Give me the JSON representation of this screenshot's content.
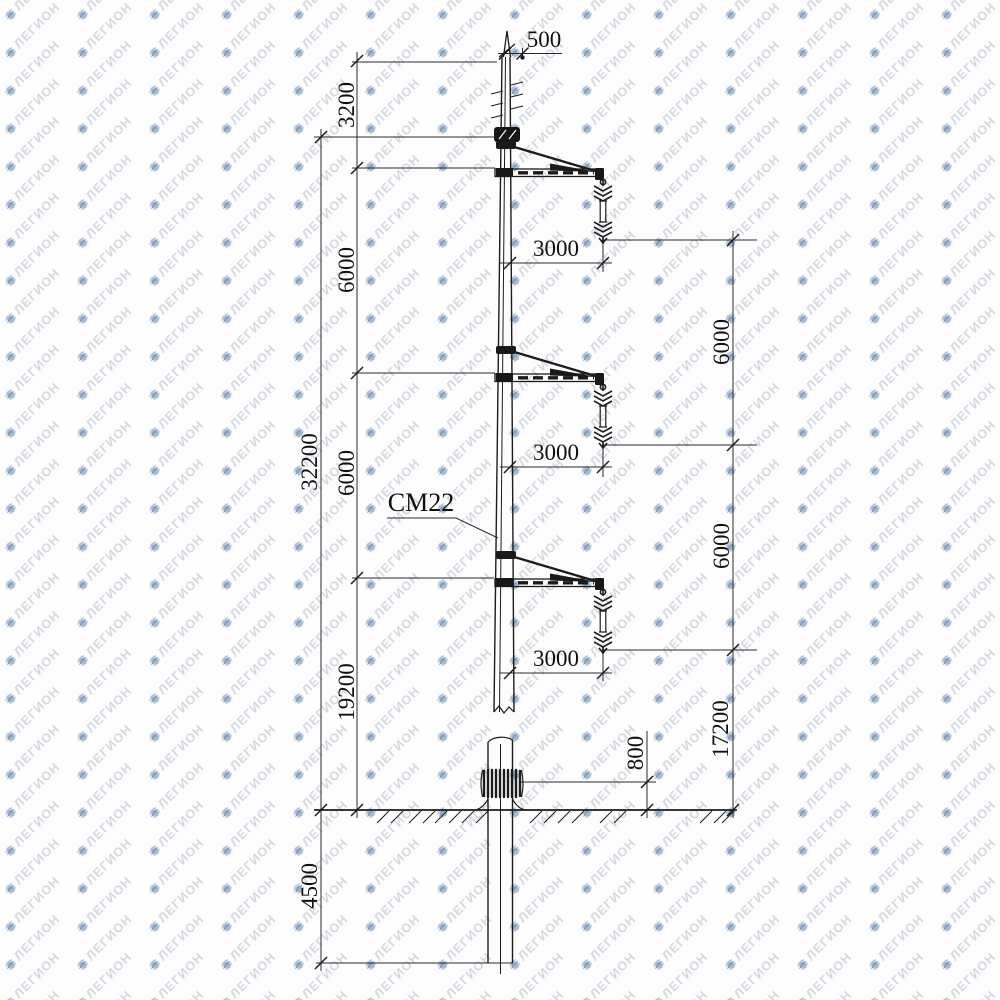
{
  "watermark": {
    "text": "ЛЕГИОН",
    "text_color": "#c9ceda",
    "icon": "legion-stack-logo",
    "icon_color": "#86a3c5"
  },
  "drawing": {
    "pole_model_label": "СМ22",
    "dims": {
      "top_offset": "500",
      "left": [
        "3200",
        "6000",
        "6000",
        "19200"
      ],
      "overall": "32200",
      "foundation_depth": "4500",
      "right": [
        "6000",
        "6000",
        "17200"
      ],
      "joint_above_ground": "800",
      "arm": [
        "3000",
        "3000",
        "3000"
      ]
    }
  }
}
